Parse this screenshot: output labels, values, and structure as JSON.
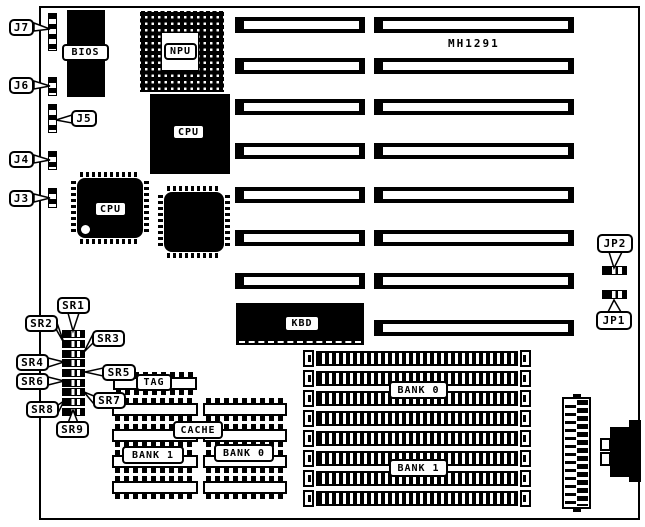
{
  "board": {
    "model": "MH1291"
  },
  "colors": {
    "background": "#ffffff",
    "line": "#000000",
    "chip_fill": "#000000",
    "label_fill": "#ffffff"
  },
  "chips": {
    "bios": "BIOS",
    "npu": "NPU",
    "cpu_pga": "CPU",
    "cpu_qfp": "CPU",
    "kbd": "KBD",
    "tag": "TAG",
    "cache": "CACHE",
    "cache_bank1": "BANK 1",
    "cache_bank0": "BANK 0"
  },
  "memory": {
    "bank0": "BANK 0",
    "bank1": "BANK 1"
  },
  "callouts": {
    "j7": "J7",
    "j6": "J6",
    "j5": "J5",
    "j4": "J4",
    "j3": "J3",
    "jp2": "JP2",
    "jp1": "JP1",
    "sr1": "SR1",
    "sr2": "SR2",
    "sr3": "SR3",
    "sr4": "SR4",
    "sr5": "SR5",
    "sr6": "SR6",
    "sr7": "SR7",
    "sr8": "SR8",
    "sr9": "SR9"
  }
}
